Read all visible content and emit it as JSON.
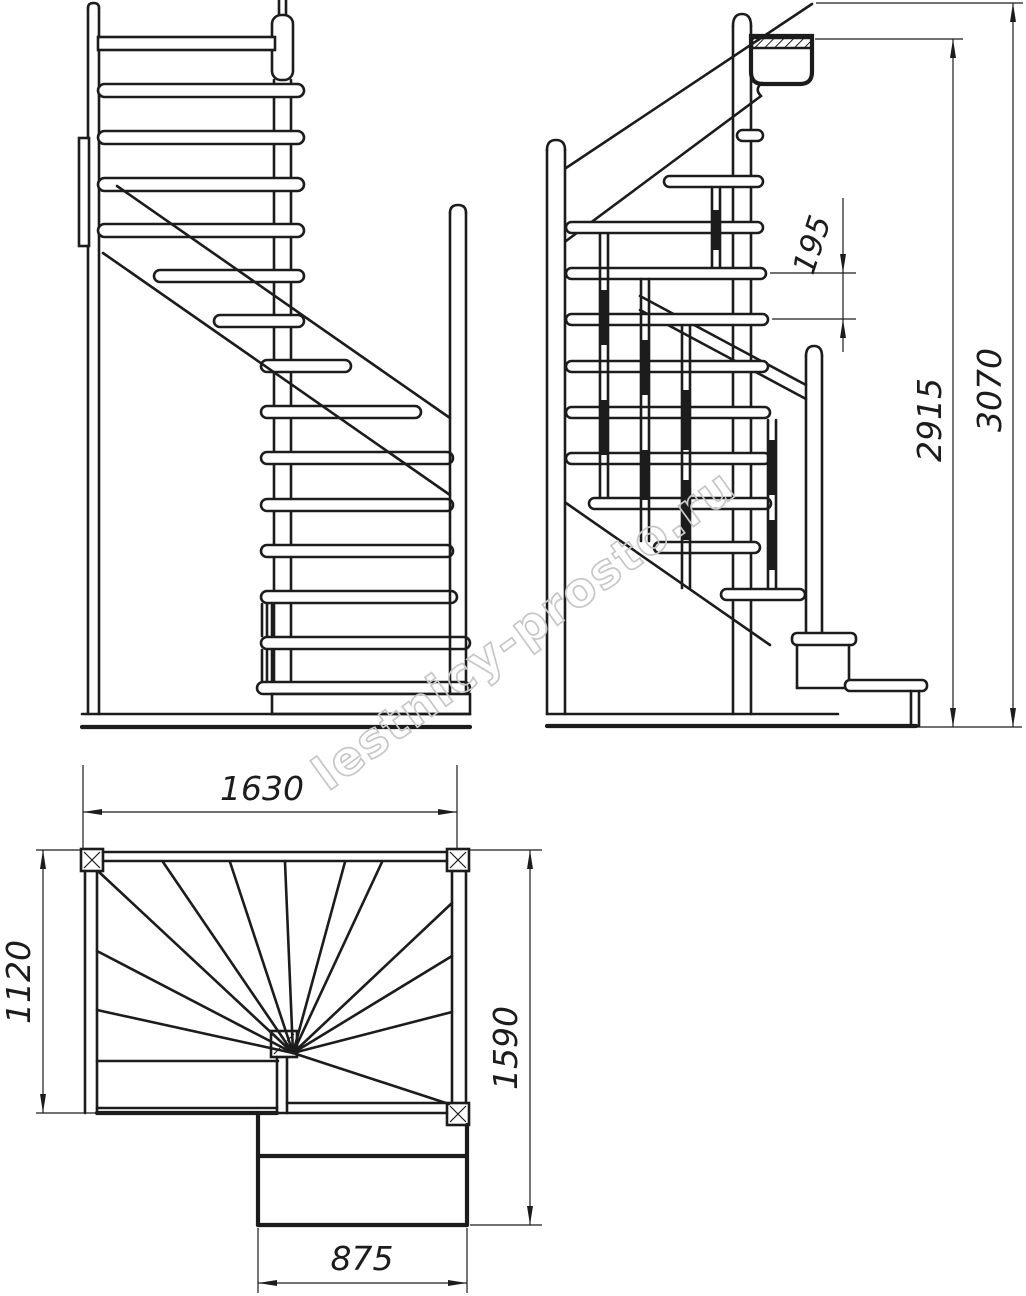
{
  "dimensions": {
    "riser_spacing": "195",
    "height_to_landing_tread": "2915",
    "overall_height": "3070",
    "plan_width_top": "1630",
    "plan_depth_left": "1120",
    "plan_depth_right": "1590",
    "plan_bottom_width": "875"
  },
  "watermark": "lestnicy-prosto.ru",
  "colors": {
    "line": "#1c1c1c",
    "watermark_outline": "#c7c7c7",
    "background": "#ffffff"
  }
}
